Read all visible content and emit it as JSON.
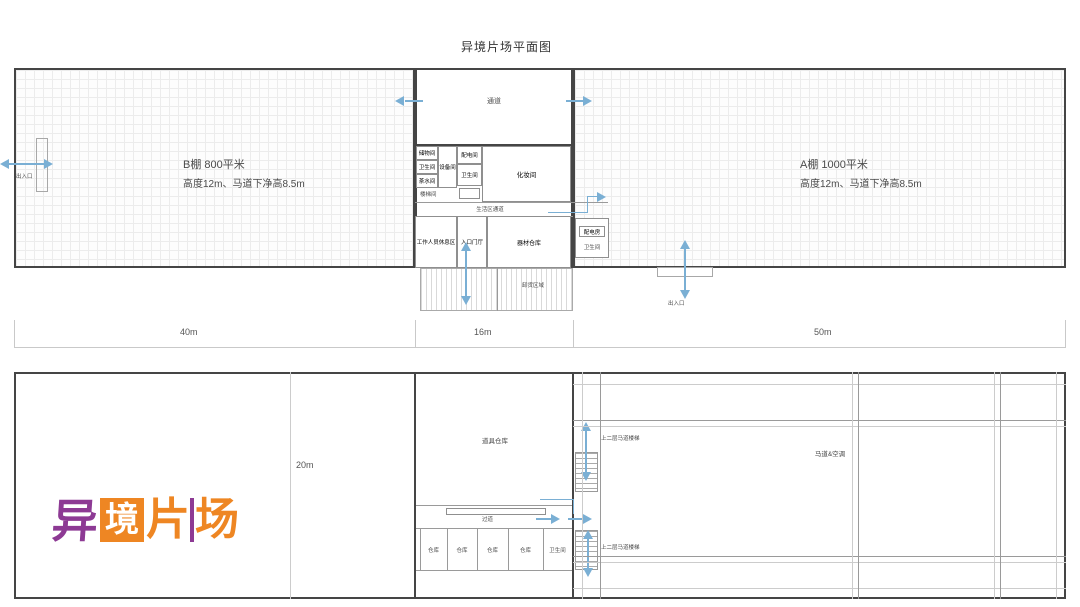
{
  "title": "异境片场平面图",
  "top_plan": {
    "studio_b": {
      "line1": "B棚 800平米",
      "line2": "高度12m、马道下净高8.5m"
    },
    "studio_a": {
      "line1": "A棚 1000平米",
      "line2": "高度12m、马道下净高8.5m"
    },
    "corridor": "通道",
    "rooms": {
      "storage": "储物间",
      "toilet1": "卫生间",
      "pantry": "茶水间",
      "stair": "楼梯间",
      "equipment": "设备间",
      "power": "配电间",
      "toilet2": "卫生间",
      "makeup": "化妆间",
      "hallway": "生活区通道",
      "rest": "工作人员休息区",
      "lobby": "入口门厅",
      "props": "器材仓库",
      "annex_box": "配电房",
      "annex_text": "卫生间"
    },
    "doors": {
      "left": "出入口",
      "bottom": "出入口"
    },
    "dock_label": "卸货区域"
  },
  "dims": {
    "b": "40m",
    "mid": "16m",
    "a": "50m"
  },
  "bottom_plan": {
    "width_label": "20m",
    "warehouse": "道具仓库",
    "corridor": "过道",
    "rooms": [
      "仓库",
      "仓库",
      "仓库",
      "仓库",
      "卫生间"
    ],
    "stair_upper": "上二层马道楼梯",
    "stair_lower": "上二层马道楼梯",
    "catwalk": "马道&空调"
  },
  "logo": {
    "char1": "异",
    "char2": "境",
    "char3": "片",
    "char4": "场"
  },
  "icons": {
    "direction-arrow-icon": "css-triangle-blue",
    "double-arrow-icon": "css-triangle-blue-both-ends"
  },
  "colors": {
    "arrow_blue": "#7aafd4",
    "wall_dark": "#454545",
    "grid_light": "#ececec",
    "logo_purple": "#8d3a94",
    "logo_orange": "#ee8623"
  }
}
